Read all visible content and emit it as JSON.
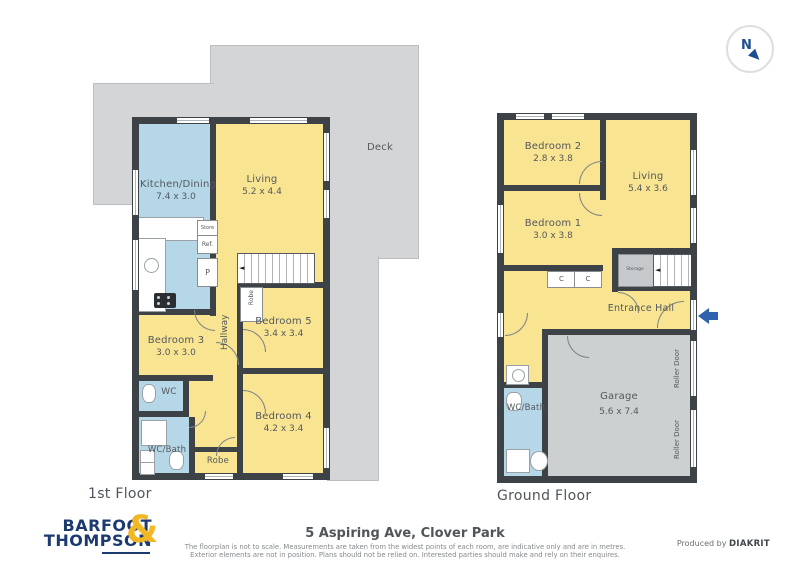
{
  "compass": {
    "north": "N"
  },
  "deck": {
    "label": "Deck"
  },
  "floor1": {
    "caption": "1st Floor",
    "kitchen": {
      "name": "Kitchen/Dining",
      "dims": "7.4 x 3.0"
    },
    "living": {
      "name": "Living",
      "dims": "5.2 x 4.4"
    },
    "bedroom5": {
      "name": "Bedroom 5",
      "dims": "3.4 x 3.4"
    },
    "bedroom4": {
      "name": "Bedroom 4",
      "dims": "4.2 x 3.4"
    },
    "bedroom3": {
      "name": "Bedroom 3",
      "dims": "3.0 x 3.0"
    },
    "hallway": "Hallway",
    "wc": "WC",
    "wc_bath": "WC/Bath",
    "robe_closet": "Robe",
    "robe_bottom": "Robe",
    "store": "Store",
    "fridge": "Ref.",
    "pantry": "P"
  },
  "floor2": {
    "caption": "Ground Floor",
    "bedroom2": {
      "name": "Bedroom 2",
      "dims": "2.8 x 3.8"
    },
    "living": {
      "name": "Living",
      "dims": "5.4 x 3.6"
    },
    "bedroom1": {
      "name": "Bedroom 1",
      "dims": "3.0 x 3.8"
    },
    "closet1": "C",
    "closet2": "C",
    "storage": "Storage",
    "entrance_hall": "Entrance Hall",
    "garage": {
      "name": "Garage",
      "dims": "5.6 x 7.4"
    },
    "wc_bath": "WC/Bath",
    "roller_door_top": "Roller Door",
    "roller_door_bottom": "Roller Door"
  },
  "footer": {
    "logo_line1": "BARFOOT",
    "logo_line2": "THOMPSON",
    "logo_amp": "&",
    "address": "5 Aspiring Ave, Clover Park",
    "disclaimer_line1": "The floorplan is not to scale. Measurements are taken from the widest points of each room, are indicative only and are in metres.",
    "disclaimer_line2": "Exterior elements are not in position. Plans should not be relied on. Interested parties should make and rely on their enquires.",
    "produced_by": "Produced by",
    "producer": "DIAKRIT"
  },
  "colors": {
    "wall": "#3d4247",
    "room_yellow": "#f8e491",
    "room_blue": "#b6d7e8",
    "deck_gray": "#d3d5d6",
    "garage_gray": "#cdd0d1",
    "logo_navy": "#1d3a70",
    "logo_gold": "#f2b724",
    "compass_navy": "#1d4e8f",
    "entrance_arrow_blue": "#2f62ac"
  }
}
